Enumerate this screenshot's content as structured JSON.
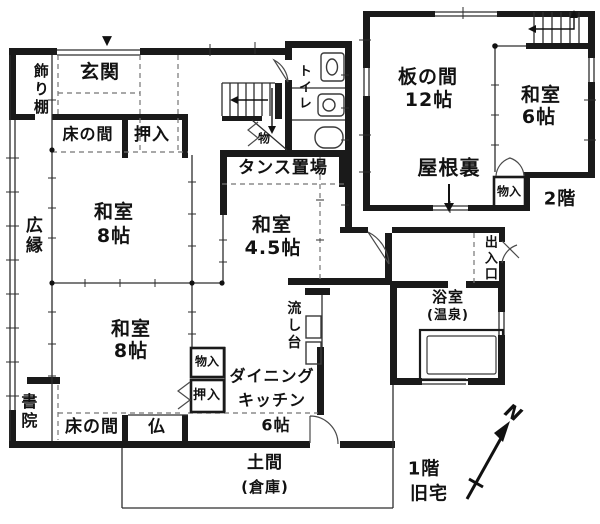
{
  "first_floor": {
    "entrance_marker": "▼",
    "kazaridana": "飾り棚",
    "genkan": "玄関",
    "tokonoma_upper": "床の間",
    "oshiire_upper": "押入",
    "washitsu_upper_name": "和室",
    "washitsu_upper_size": "8帖",
    "hiroen": "広縁",
    "toilet": "トイレ",
    "under_stairs_storage": "物",
    "tansu_okiba": "タンス置場",
    "washitsu_mid_name": "和室",
    "washitsu_mid_size": "4.5帖",
    "washitsu_lower_name": "和室",
    "washitsu_lower_size": "8帖",
    "monoire": "物入",
    "oshiire_lower": "押入",
    "nagashidai": "流し台",
    "dining_line1": "ダイニング",
    "dining_line2": "キッチン",
    "dining_size": "6帖",
    "shoin": "書院",
    "tokonoma_lower": "床の間",
    "butsuma": "仏",
    "doma": "土間",
    "doma_note": "(倉庫)",
    "deiriguchi": "出入口",
    "bathroom": "浴室",
    "bathroom_note": "(温泉)",
    "floor_label": "1階",
    "floor_sublabel": "旧宅"
  },
  "second_floor": {
    "itanoma_name": "板の間",
    "itanoma_size": "12帖",
    "washitsu_name": "和室",
    "washitsu_size": "6帖",
    "yaneura": "屋根裏",
    "monoire": "物入",
    "floor_label": "2階"
  },
  "compass": {
    "north": "N"
  }
}
